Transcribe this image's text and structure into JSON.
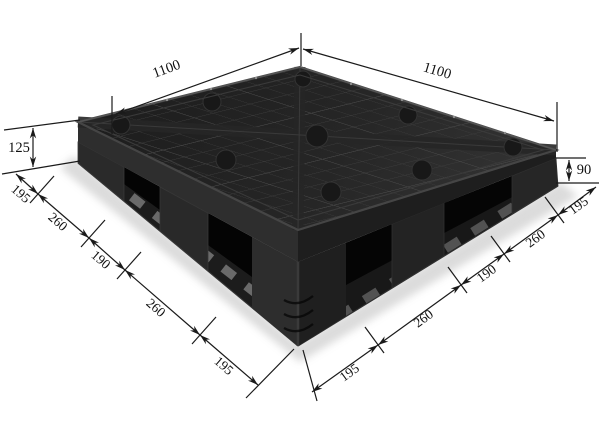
{
  "figure": {
    "subject": "Black plastic pallet, corner perspective product photo with dimension callouts",
    "background_color": "#ffffff",
    "pallet_color": "#222222",
    "annotation_color": "#1a1a1a"
  },
  "dimensions": {
    "top_left_edge": "1100",
    "top_right_edge": "1100",
    "left_overall_height": "125",
    "right_fork_opening_height": "90",
    "left_bottom_edge_segments": [
      "195",
      "260",
      "190",
      "260",
      "195"
    ],
    "right_bottom_edge_segments": [
      "195",
      "260",
      "190",
      "260",
      "195"
    ]
  }
}
